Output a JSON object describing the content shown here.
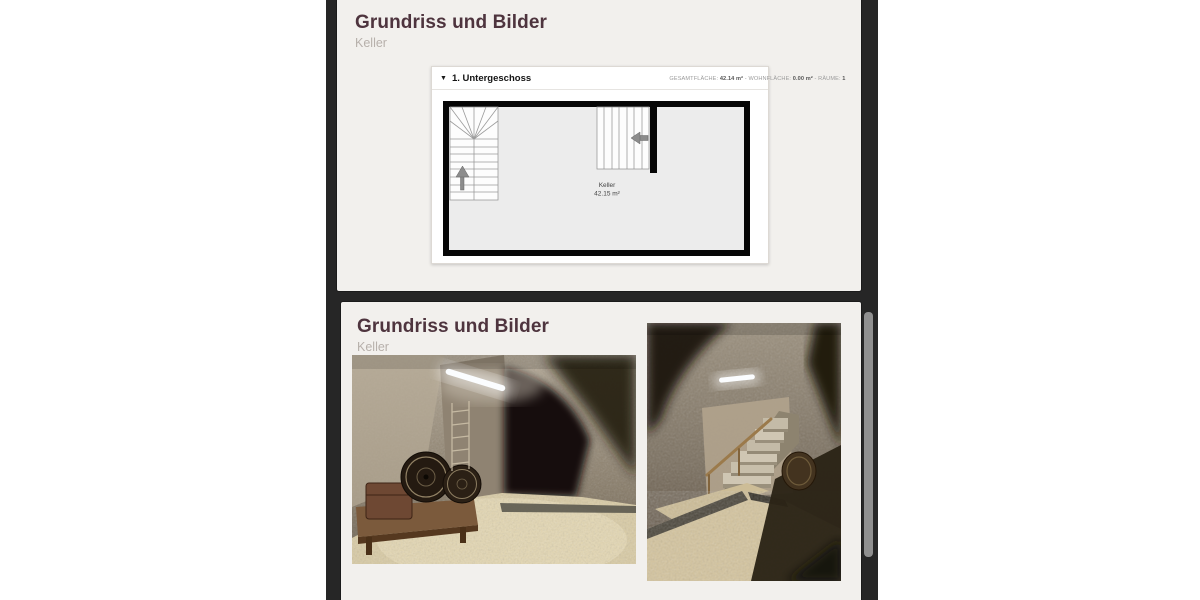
{
  "viewer": {
    "background_color": "#262626",
    "page_color": "#f2f0ed",
    "title_color": "#4e343e",
    "subtitle_color": "#b7b0ab",
    "scrollbar_thumb_color": "#8f8f8f"
  },
  "pages": [
    {
      "title": "Grundriss und Bilder",
      "subtitle": "Keller",
      "floorplan": {
        "collapse_icon": "▼",
        "level_label": "1. Untergeschoss",
        "stats": [
          {
            "label": "GESAMTFLÄCHE:",
            "value": "42.14 m²"
          },
          {
            "label": "WOHNFLÄCHE:",
            "value": "0.00 m²"
          },
          {
            "label": "RÄUME:",
            "value": "1"
          }
        ],
        "stats_separator": "-",
        "room": {
          "name": "Keller",
          "area": "42.15 m²"
        }
      }
    },
    {
      "title": "Grundriss und Bilder",
      "subtitle": "Keller",
      "photos": [
        {
          "alt": "Gewölbekeller mit Holzfässern, Leiter und Kiesboden"
        },
        {
          "alt": "Gewölbekeller mit Treppe, Handlauf und Kiesboden"
        }
      ]
    }
  ]
}
